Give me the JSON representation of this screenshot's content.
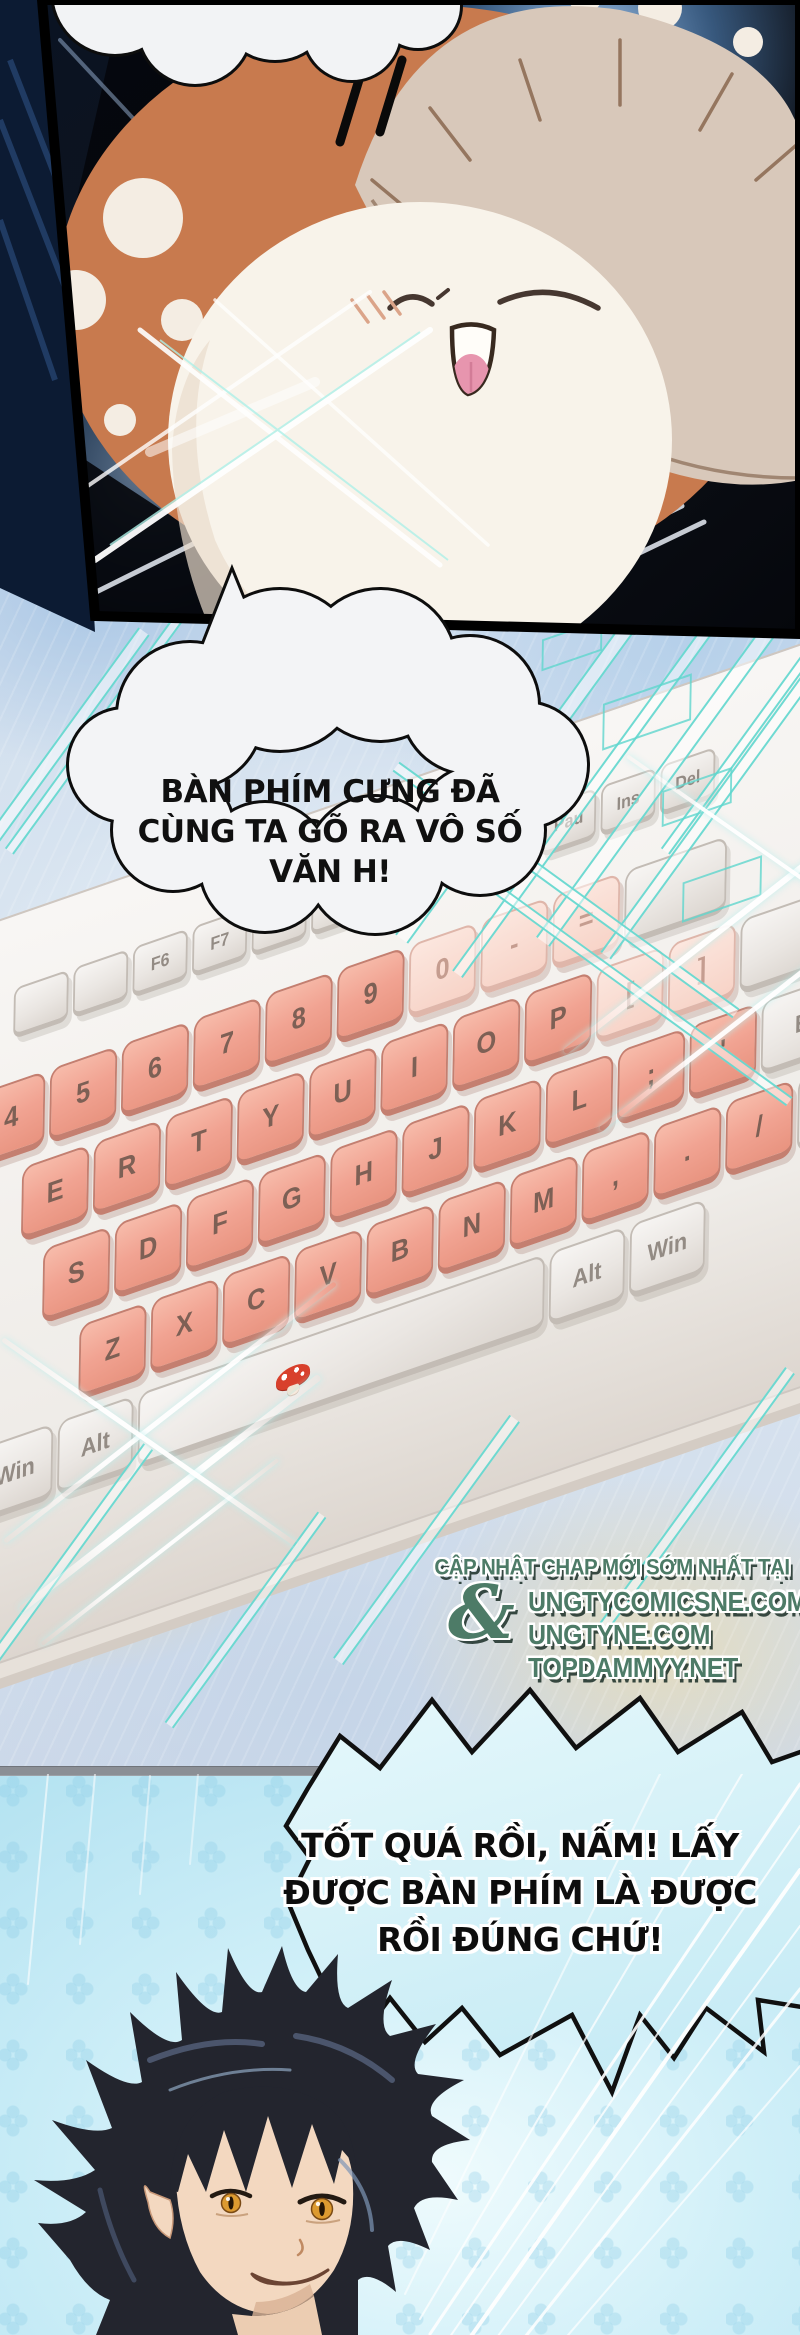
{
  "page": {
    "type": "manhua-comic-page",
    "width": 800,
    "height": 2335
  },
  "panel_top": {
    "subject": "mushroom-mascot-closeup"
  },
  "panel_middle": {
    "speech_bubble": {
      "lines": [
        "BÀN PHÍM CƯNG ĐÃ",
        "CÙNG TA GÕ RA VÔ SỐ",
        "VĂN H!"
      ]
    },
    "keyboard": {
      "fn_row": [
        "",
        "",
        "F6",
        "F7",
        "",
        ""
      ],
      "nav_keys": [
        "Pau",
        "Ins",
        "Del"
      ],
      "num_row": [
        "4",
        "5",
        "6",
        "7",
        "8",
        "9",
        "0",
        "-",
        "="
      ],
      "top_row": [
        "E",
        "R",
        "T",
        "Y",
        "U",
        "I",
        "O",
        "P",
        "[",
        "]"
      ],
      "home_row": [
        "S",
        "D",
        "F",
        "G",
        "H",
        "J",
        "K",
        "L",
        ";",
        "'"
      ],
      "bottom_row": [
        "Z",
        "X",
        "C",
        "V",
        "B",
        "N",
        "M",
        ",",
        ".",
        "/"
      ],
      "mod_row_left": [
        "Win",
        "Alt"
      ],
      "mod_row_right": [
        "Alt",
        "Win"
      ],
      "enter_key": "Enter",
      "shift_key": "Shift"
    },
    "watermark": {
      "tagline": "CẬP NHẬT CHAP MỚI SỚM NHẤT TẠI",
      "ampersand": "&",
      "sites": [
        "UNGTYCOMICSNE.COM",
        "UNGTYNE.COM",
        "TOPDAMMYY.NET"
      ]
    }
  },
  "panel_bottom": {
    "speech_bubble": {
      "lines": [
        "TỐT QUÁ RỒI, NẤM! LẤY",
        "ĐƯỢC BÀN PHÍM LÀ ĐƯỢC",
        "RỒI ĐÚNG CHỨ!"
      ]
    },
    "subject": "black-haired-man"
  },
  "colors": {
    "key_salmon": "#f1a392",
    "key_white": "#efeceb",
    "glitch_teal": "#5fd6cd",
    "watermark_green": "#4d7b67",
    "bubble_blue": "#d6f2f8",
    "bottom_panel_blue": "#bfe7f3",
    "mushroom_cap_orange": "#c87a4e",
    "mushroom_cap_tan": "#d8c8ba"
  }
}
